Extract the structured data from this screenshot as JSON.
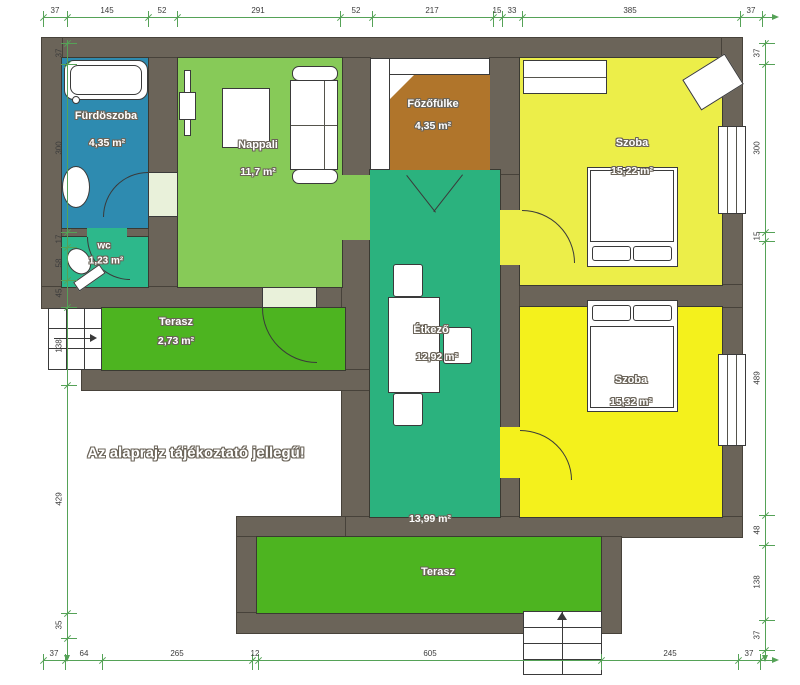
{
  "disclaimer": "Az alaprajz tájékoztató jellegű!",
  "rooms": {
    "bathroom": {
      "name": "Fürdöszoba",
      "area": "4,35 m²"
    },
    "wc": {
      "name": "wc",
      "area": "1,23 m²"
    },
    "living": {
      "name": "Nappali",
      "area": "11,7 m²"
    },
    "kitchenette": {
      "name": "Főzőfülke",
      "area": "4,35 m²"
    },
    "room1": {
      "name": "Szoba",
      "area": "15,22 m²"
    },
    "dining": {
      "name": "Étkező",
      "area": "12,92 m²"
    },
    "hall": {
      "area": "13,99 m²"
    },
    "room2": {
      "name": "Szoba",
      "area": "15,32 m²"
    },
    "terraceLeft": {
      "name": "Terasz",
      "area": "2,73 m²"
    },
    "terraceBottom": {
      "name": "Terasz"
    }
  },
  "colors": {
    "wall": "#6b6459",
    "bathroom": "#2e8bb0",
    "wc": "#2db88b",
    "living": "#87ca58",
    "kitchenette": "#b0752b",
    "room1": "#ecee49",
    "room2": "#f4f11c",
    "dining": "#2bb27e",
    "terrace": "#4db420",
    "dimension": "#55a257"
  },
  "dimensions": {
    "top": {
      "orientation": "h",
      "pos": 17,
      "from": 43,
      "to": 772,
      "ticks": [
        43,
        67,
        148,
        177,
        340,
        372,
        493,
        502,
        522,
        740,
        762
      ],
      "labels": [
        [
          "37",
          55
        ],
        [
          "145",
          107
        ],
        [
          "52",
          162
        ],
        [
          "291",
          258
        ],
        [
          "52",
          356
        ],
        [
          "217",
          432
        ],
        [
          "15",
          497
        ],
        [
          "33",
          512
        ],
        [
          "385",
          630
        ],
        [
          "37",
          751
        ]
      ]
    },
    "bottom": {
      "orientation": "h",
      "pos": 660,
      "from": 43,
      "to": 772,
      "ticks": [
        43,
        65,
        102,
        252,
        258,
        601,
        738,
        760
      ],
      "labels": [
        [
          "37",
          54
        ],
        [
          "64",
          84
        ],
        [
          "265",
          177
        ],
        [
          "12",
          255
        ],
        [
          "605",
          430
        ],
        [
          "245",
          670
        ],
        [
          "37",
          749
        ]
      ]
    },
    "left": {
      "orientation": "v",
      "pos": 67,
      "from": 40,
      "to": 655,
      "ticks": [
        43,
        64,
        232,
        247,
        280,
        307,
        385,
        613,
        638
      ],
      "labels": [
        [
          "37",
          53
        ],
        [
          "300",
          148
        ],
        [
          "17",
          239
        ],
        [
          "58",
          263
        ],
        [
          "45",
          293
        ],
        [
          "138",
          346
        ],
        [
          "429",
          499
        ],
        [
          "35",
          625
        ]
      ]
    },
    "right": {
      "orientation": "v",
      "pos": 765,
      "from": 40,
      "to": 655,
      "ticks": [
        43,
        64,
        232,
        241,
        515,
        545,
        620,
        650
      ],
      "labels": [
        [
          "37",
          53
        ],
        [
          "300",
          148
        ],
        [
          "15",
          236
        ],
        [
          "489",
          378
        ],
        [
          "48",
          530
        ],
        [
          "138",
          582
        ],
        [
          "37",
          635
        ]
      ]
    }
  }
}
